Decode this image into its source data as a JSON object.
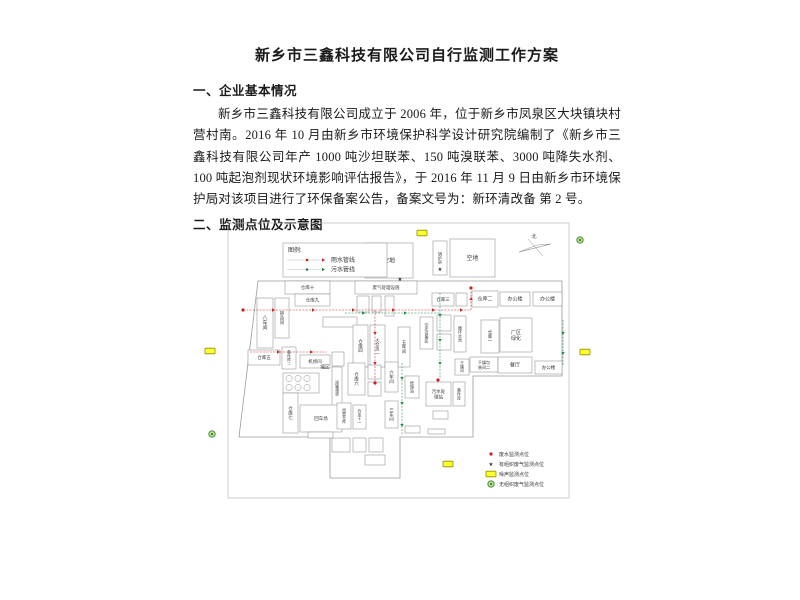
{
  "page": {
    "title": "新乡市三鑫科技有限公司自行监测工作方案",
    "section1_heading": "一、企业基本情况",
    "section1_paragraph": "新乡市三鑫科技有限公司成立于 2006 年，位于新乡市凤泉区大块镇块村营村南。2016 年 10 月由新乡市环境保护科学设计研究院编制了《新乡市三鑫科技有限公司年产 1000 吨沙坦联苯、150 吨溴联苯、3000 吨降失水剂、100 吨起泡剂现状环境影响评估报告》，于 2016 年 11 月 9 日由新乡市环境保护局对该项目进行了环保备案公告，备案文号为：新环清改备 第 2 号。",
    "section2_heading": "二、监测点位及示意图"
  },
  "colors": {
    "rain_pipe": "#c42323",
    "sewage_pipe": "#1f8a4c",
    "noise_fill": "#ffff2e",
    "noise_stroke": "#8f8f00",
    "gas_fill": "#b7dc8e",
    "gas_stroke": "#3f8a33",
    "point_red": "#c42323"
  },
  "diagram": {
    "frame": [
      33,
      8,
      341,
      275
    ],
    "boundary": "63,66 367,66 367,161 278,161 278,222 205,222 205,263 135,263 135,222 44,222",
    "compass": {
      "x": 340,
      "y": 31,
      "label": "北"
    },
    "legend_top": {
      "box": [
        88,
        28,
        104,
        34
      ],
      "title": "图例:",
      "items": [
        {
          "label": "雨水管线",
          "color": "#c42323"
        },
        {
          "label": "污水管线",
          "color": "#1f8a4c"
        }
      ]
    },
    "legend_bottom": {
      "x": 291,
      "y": 235,
      "items": [
        {
          "type": "dot",
          "label": "废水监测点位"
        },
        {
          "type": "star",
          "label": "有组织废气监测点位"
        },
        {
          "type": "noise",
          "label": "噪声监测点位"
        },
        {
          "type": "gas",
          "label": "无组织废气监测点位"
        }
      ]
    },
    "buildings": [
      {
        "x": 170,
        "y": 28,
        "w": 48,
        "h": 35,
        "label": "空地",
        "fs": 6
      },
      {
        "x": 238,
        "y": 26,
        "w": 14,
        "h": 34,
        "label": "锅炉房",
        "vert": 1,
        "fs": 4
      },
      {
        "x": 255,
        "y": 24,
        "w": 45,
        "h": 38,
        "label": "空地",
        "fs": 6
      },
      {
        "x": 90,
        "y": 66,
        "w": 45,
        "h": 13,
        "label": "仓库十",
        "fs": 4.5
      },
      {
        "x": 100,
        "y": 79,
        "w": 35,
        "h": 12,
        "label": "仓库九",
        "fs": 4.5
      },
      {
        "x": 62,
        "y": 83,
        "w": 16,
        "h": 50,
        "label": "八车间",
        "vert": 1
      },
      {
        "x": 80,
        "y": 83,
        "w": 14,
        "h": 40,
        "label": "掺合间",
        "vert": 1,
        "fs": 4.5
      },
      {
        "x": 128,
        "y": 102,
        "w": 34,
        "h": 10
      },
      {
        "x": 160,
        "y": 66,
        "w": 62,
        "h": 13,
        "label": "废气处理设施",
        "fs": 4.5
      },
      {
        "x": 162,
        "y": 81,
        "w": 12,
        "h": 16
      },
      {
        "x": 177,
        "y": 81,
        "w": 9,
        "h": 16
      },
      {
        "x": 190,
        "y": 81,
        "w": 9,
        "h": 20
      },
      {
        "x": 237,
        "y": 78,
        "w": 22,
        "h": 13,
        "label": "仓库三",
        "fs": 4.5
      },
      {
        "x": 261,
        "y": 78,
        "w": 11,
        "h": 13
      },
      {
        "x": 277,
        "y": 76,
        "w": 26,
        "h": 16,
        "label": "仓库二",
        "fs": 5
      },
      {
        "x": 305,
        "y": 77,
        "w": 30,
        "h": 14,
        "label": "办公楼",
        "fs": 5
      },
      {
        "x": 338,
        "y": 77,
        "w": 29,
        "h": 14,
        "label": "办公楼",
        "fs": 5
      },
      {
        "x": 158,
        "y": 110,
        "w": 15,
        "h": 42,
        "label": "仓库四",
        "vert": 1,
        "fs": 4.5
      },
      {
        "x": 175,
        "y": 110,
        "w": 15,
        "h": 42,
        "label": "大仓库二",
        "vert": 1,
        "fs": 4
      },
      {
        "x": 203,
        "y": 112,
        "w": 12,
        "h": 40,
        "label": "五车间",
        "vert": 1,
        "fs": 4.5
      },
      {
        "x": 225,
        "y": 102,
        "w": 13,
        "h": 32,
        "label": "空压设备区",
        "vert": 1,
        "fs": 4
      },
      {
        "x": 242,
        "y": 100,
        "w": 14,
        "h": 16
      },
      {
        "x": 242,
        "y": 119,
        "w": 14,
        "h": 16
      },
      {
        "x": 259,
        "y": 101,
        "w": 12,
        "h": 36,
        "label": "循环水池",
        "vert": 1,
        "fs": 4
      },
      {
        "x": 286,
        "y": 105,
        "w": 18,
        "h": 33,
        "label": "仓库一",
        "vert": 1,
        "fs": 4.5
      },
      {
        "x": 305,
        "y": 103,
        "w": 32,
        "h": 34,
        "label": "厂区\n绿化",
        "fs": 5
      },
      {
        "x": 53,
        "y": 135,
        "w": 32,
        "h": 15,
        "label": "仓库五",
        "fs": 4.5
      },
      {
        "x": 87,
        "y": 132,
        "w": 14,
        "h": 22,
        "label": "备件库二",
        "vert": 1,
        "fs": 3.8
      },
      {
        "x": 105,
        "y": 140,
        "w": 30,
        "h": 13,
        "label": "机修间",
        "fs": 4.5
      },
      {
        "x": 137,
        "y": 137,
        "w": 12,
        "h": 14
      },
      {
        "x": 123,
        "y": 149,
        "w": 14,
        "h": 6,
        "label": "罐区",
        "nobox": 1,
        "fs": 4.5
      },
      {
        "x": 88,
        "y": 158,
        "w": 36,
        "h": 20,
        "tank": 1
      },
      {
        "x": 137,
        "y": 152,
        "w": 10,
        "h": 42,
        "label": "运输通道",
        "vert": 1,
        "fs": 3.8
      },
      {
        "x": 88,
        "y": 178,
        "w": 15,
        "h": 40,
        "label": "仓库七",
        "vert": 1,
        "fs": 4.5
      },
      {
        "x": 105,
        "y": 190,
        "w": 42,
        "h": 27,
        "label": "回车场",
        "fs": 4.5
      },
      {
        "x": 113,
        "y": 217,
        "w": 25,
        "h": 6
      },
      {
        "x": 142,
        "y": 188,
        "w": 14,
        "h": 26,
        "label": "闲置仓库",
        "vert": 1,
        "fs": 3.8
      },
      {
        "x": 158,
        "y": 190,
        "w": 13,
        "h": 24,
        "label": "仓库十一",
        "vert": 1,
        "fs": 3.8
      },
      {
        "x": 153,
        "y": 148,
        "w": 17,
        "h": 32,
        "label": "仓库六",
        "vert": 1,
        "fs": 4.5
      },
      {
        "x": 173,
        "y": 150,
        "w": 13,
        "h": 14
      },
      {
        "x": 173,
        "y": 167,
        "w": 13,
        "h": 14
      },
      {
        "x": 190,
        "y": 147,
        "w": 13,
        "h": 30,
        "label": "六车间",
        "vert": 1,
        "fs": 4.5
      },
      {
        "x": 190,
        "y": 186,
        "w": 13,
        "h": 27,
        "label": "三车间",
        "vert": 1,
        "fs": 4.5
      },
      {
        "x": 210,
        "y": 161,
        "w": 14,
        "h": 22,
        "label": "修理站",
        "vert": 1,
        "fs": 4
      },
      {
        "x": 231,
        "y": 167,
        "w": 25,
        "h": 24,
        "label": "污水处\n理站",
        "fs": 4.5
      },
      {
        "x": 258,
        "y": 167,
        "w": 12,
        "h": 24,
        "label": "备件库",
        "vert": 1,
        "fs": 4
      },
      {
        "x": 260,
        "y": 144,
        "w": 14,
        "h": 16,
        "label": "干燥间",
        "vert": 1,
        "fs": 3.8
      },
      {
        "x": 275,
        "y": 142,
        "w": 28,
        "h": 15,
        "label": "干燥包\n装间二",
        "fs": 4
      },
      {
        "x": 303,
        "y": 142,
        "w": 34,
        "h": 16,
        "label": "餐厅",
        "fs": 5
      },
      {
        "x": 340,
        "y": 146,
        "w": 27,
        "h": 13,
        "label": "办公楼",
        "fs": 4.5
      },
      {
        "x": 137,
        "y": 223,
        "w": 18,
        "h": 14
      },
      {
        "x": 158,
        "y": 223,
        "w": 13,
        "h": 14
      },
      {
        "x": 174,
        "y": 223,
        "w": 14,
        "h": 14
      },
      {
        "x": 170,
        "y": 240,
        "w": 20,
        "h": 10
      },
      {
        "x": 238,
        "y": 196,
        "w": 15,
        "h": 8
      },
      {
        "x": 210,
        "y": 211,
        "w": 15,
        "h": 7
      },
      {
        "x": 233,
        "y": 214,
        "w": 17,
        "h": 5
      }
    ],
    "pipes": [
      {
        "kind": "rain",
        "pts": "48,95 276,95",
        "arrows": [
          [
            80,
            95,
            "r"
          ],
          [
            120,
            95,
            "r"
          ],
          [
            160,
            95,
            "r"
          ],
          [
            200,
            95,
            "r"
          ],
          [
            240,
            95,
            "r"
          ],
          [
            268,
            95,
            "r"
          ]
        ]
      },
      {
        "kind": "rain",
        "pts": "276,95 276,76",
        "arrows": [
          [
            276,
            82,
            "u"
          ]
        ]
      },
      {
        "kind": "rain",
        "pts": "55,137 132,137",
        "arrows": [
          [
            85,
            137,
            "r"
          ],
          [
            118,
            137,
            "r"
          ]
        ]
      },
      {
        "kind": "rain",
        "pts": "180,95 180,168",
        "arrows": [
          [
            180,
            120,
            "d"
          ],
          [
            180,
            150,
            "d"
          ]
        ]
      },
      {
        "kind": "sewage",
        "pts": "150,98 245,98",
        "arrows": [
          [
            170,
            98,
            "r"
          ],
          [
            212,
            98,
            "r"
          ]
        ]
      },
      {
        "kind": "sewage",
        "pts": "245,78 245,163",
        "arrows": [
          [
            245,
            102,
            "d"
          ],
          [
            245,
            127,
            "d"
          ],
          [
            245,
            150,
            "d"
          ]
        ]
      },
      {
        "kind": "sewage",
        "pts": "207,148 207,220",
        "arrows": [
          [
            207,
            165,
            "d"
          ],
          [
            207,
            190,
            "d"
          ],
          [
            207,
            212,
            "d"
          ]
        ]
      },
      {
        "kind": "sewage",
        "pts": "368,105 368,150",
        "arrows": [
          [
            368,
            120,
            "d"
          ],
          [
            368,
            140,
            "d"
          ]
        ]
      }
    ],
    "markers": [
      {
        "type": "noise",
        "x": 227,
        "y": 18
      },
      {
        "type": "noise",
        "x": 15,
        "y": 136
      },
      {
        "type": "noise",
        "x": 390,
        "y": 137
      },
      {
        "type": "noise",
        "x": 253,
        "y": 249
      },
      {
        "type": "gas",
        "x": 385,
        "y": 25
      },
      {
        "type": "gas",
        "x": 17,
        "y": 219
      },
      {
        "type": "star",
        "x": 205,
        "y": 64
      },
      {
        "type": "star",
        "x": 245,
        "y": 54
      },
      {
        "type": "dot",
        "x": 48,
        "y": 95
      },
      {
        "type": "dot",
        "x": 180,
        "y": 168
      },
      {
        "type": "dot",
        "x": 276,
        "y": 73
      },
      {
        "type": "dot",
        "x": 243,
        "y": 165
      }
    ]
  }
}
